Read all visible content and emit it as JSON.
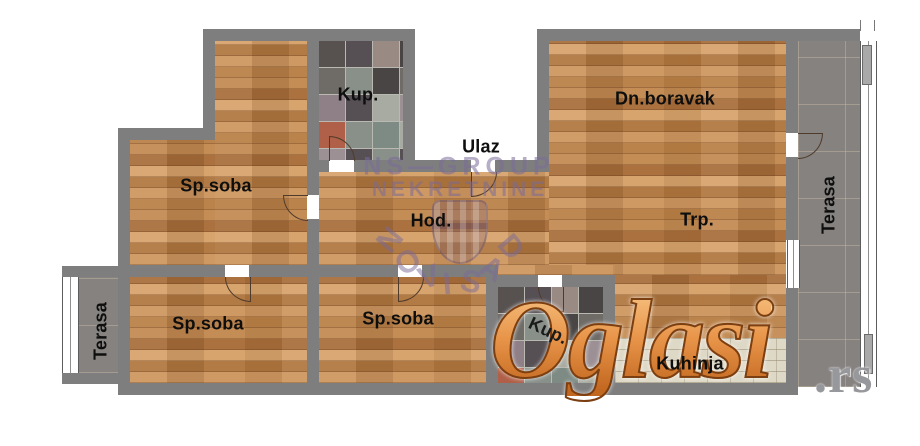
{
  "rooms": {
    "kup_top": {
      "label": "Kup."
    },
    "ulaz": {
      "label": "Ulaz"
    },
    "dn_boravak": {
      "label": "Dn.boravak"
    },
    "sp_soba_top": {
      "label": "Sp.soba"
    },
    "hod": {
      "label": "Hod."
    },
    "trp": {
      "label": "Trp."
    },
    "terasa_right": {
      "label": "Terasa"
    },
    "sp_soba_bottom_left": {
      "label": "Sp.soba"
    },
    "sp_soba_bottom_mid": {
      "label": "Sp.soba"
    },
    "kup_bottom": {
      "label": "Kup."
    },
    "kuhinja": {
      "label": "Kuhinja"
    },
    "terasa_left": {
      "label": "Terasa"
    }
  },
  "watermarks": {
    "agency": {
      "line1": "NS—GROUP",
      "line2": "NEKRETNINE",
      "arc_letters": [
        "N",
        "O",
        "V",
        "I",
        "S",
        "A",
        "D"
      ]
    },
    "portal": {
      "name": "Oglasi",
      "tld": ".rs"
    }
  },
  "colors": {
    "wall_gray": "#7e7e7e",
    "wood_base": "#c08550",
    "terrace_tile": "#868280",
    "kitchen_tile": "#ded8c6",
    "watermark_purple": "#7a6a98",
    "portal_orange": "#e8954a",
    "portal_tld_gray": "#97989b",
    "bath_palette": [
      "#575150",
      "#89908a",
      "#9a8a84",
      "#b06048",
      "#a8aba1",
      "#6f6b67",
      "#7e8b85",
      "#565055",
      "#9c9094",
      "#4a4545",
      "#8f7f86",
      "#746f6b"
    ]
  }
}
